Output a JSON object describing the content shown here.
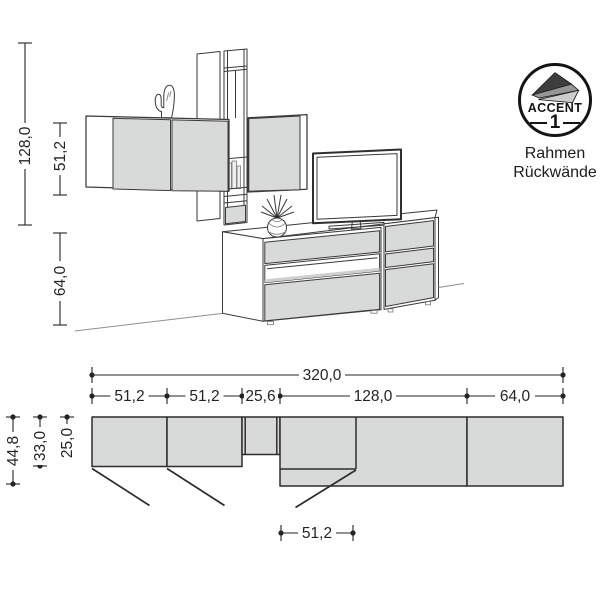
{
  "colors": {
    "panel_fill": "#d8d9d9",
    "line": "#3a3a3a",
    "dim": "#242424",
    "badge_ink": "#141414"
  },
  "elevation": {
    "dim_total_height": "128,0",
    "dim_wall_cabinet_height": "51,2",
    "dim_sideboard_height": "64,0"
  },
  "plan": {
    "dim_total_width": "320,0",
    "dim_segments": [
      "51,2",
      "51,2",
      "25,6",
      "128,0",
      "64,0"
    ],
    "dim_depths": [
      "44,8",
      "33,0",
      "25,0"
    ],
    "dim_detail_width": "51,2"
  },
  "badge": {
    "brand": "ACCENT",
    "number": "1",
    "caption_line1": "Rahmen",
    "caption_line2": "Rückwände"
  }
}
